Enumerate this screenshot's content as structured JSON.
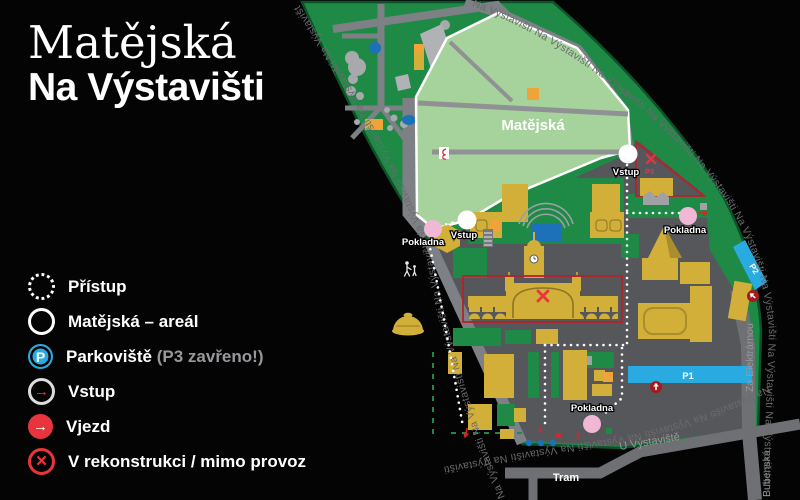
{
  "title": {
    "line1": "Matějská",
    "line2": "Na Výstavišti"
  },
  "legend": {
    "items": [
      {
        "label": "Přístup",
        "icon": "dotted-circle"
      },
      {
        "label": "Matějská – areál",
        "icon": "solid-ring"
      },
      {
        "label": "Parkoviště",
        "note": "(P3 zavřeno!)",
        "icon": "parking-circle",
        "glyph": "P"
      },
      {
        "label": "Vstup",
        "icon": "ring-red-arrow",
        "glyph": "→"
      },
      {
        "label": "Vjezd",
        "icon": "red-circle-arrow",
        "glyph": "→"
      },
      {
        "label": "V rekonstrukci / mimo provoz",
        "icon": "red-x-circle",
        "glyph": "×"
      }
    ]
  },
  "map": {
    "area_label": "Matějská",
    "street_text": {
      "repeat_left": "Na Výstavišti Na Výstavišti Na Výstavišti Na Výstavišti Na Výstavišti Na Výstavišti Na Výstavišti Na Výstavišti",
      "repeat_right": "Na Výstavišti Na Výstavišti Na Výstavišti Na Výstavišti Na Výstavišti Na Výstavišti Na Výstavišti Na Výstavišti Na Výstavišti Na Výstavišti",
      "repeat_bottom": "Na Výstavišti Na Výstavišti Na Výstavišti Na Výstavišti Na Výstavišti"
    },
    "streets": {
      "za_elektrarnou": "Za Elektrárnou",
      "bubenska": "Bubenská",
      "u_vystaviste": "U Výstaviště",
      "tram": "Tram"
    },
    "markers": {
      "vstup": "Vstup",
      "pokladna": "Pokladna",
      "p1": "P1",
      "p2": "P2",
      "p3": "P3"
    },
    "colors": {
      "park_green": "#1e8a46",
      "area_light_green": "#a6d29c",
      "building_yellow": "#d2af39",
      "parking_blue": "#29abe2",
      "accent_red": "#e8353c",
      "ticket_pink": "#f0b8d4",
      "road_gray": "#7d8084",
      "grounds_gray": "#56575a"
    }
  }
}
